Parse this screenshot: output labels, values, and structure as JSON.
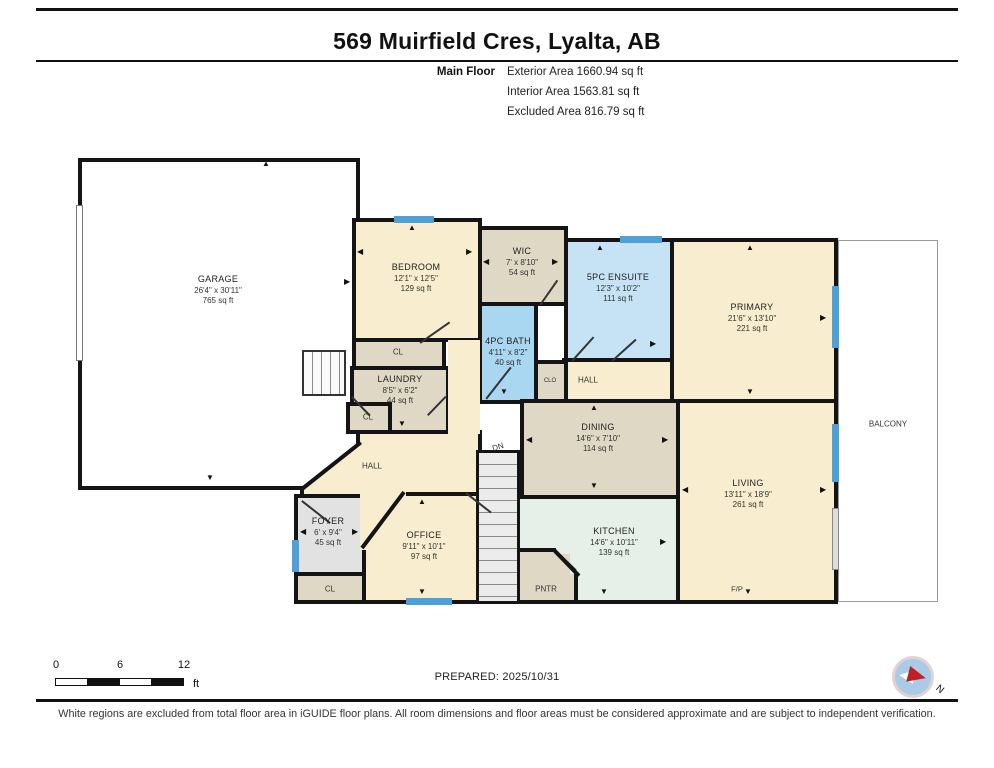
{
  "header": {
    "title": "569 Muirfield Cres, Lyalta, AB",
    "floor_label": "Main Floor",
    "areas": {
      "exterior": "Exterior Area 1660.94 sq ft",
      "interior": "Interior Area 1563.81 sq ft",
      "excluded": "Excluded Area 816.79 sq ft"
    }
  },
  "rooms": {
    "garage": {
      "name": "GARAGE",
      "dims": "26'4\" x 30'11\"",
      "area": "765 sq ft"
    },
    "bedroom": {
      "name": "BEDROOM",
      "dims": "12'1\" x 12'5\"",
      "area": "129 sq ft"
    },
    "wic": {
      "name": "WIC",
      "dims": "7' x 8'10\"",
      "area": "54 sq ft"
    },
    "bath": {
      "name": "4PC BATH",
      "dims": "4'11\" x 8'2\"",
      "area": "40 sq ft"
    },
    "ensuite": {
      "name": "5PC ENSUITE",
      "dims": "12'3\" x 10'2\"",
      "area": "111 sq ft"
    },
    "primary": {
      "name": "PRIMARY",
      "dims": "21'6\" x 13'10\"",
      "area": "221 sq ft"
    },
    "laundry": {
      "name": "LAUNDRY",
      "dims": "8'5\" x 6'2\"",
      "area": "44 sq ft"
    },
    "dining": {
      "name": "DINING",
      "dims": "14'6\" x 7'10\"",
      "area": "114 sq ft"
    },
    "kitchen": {
      "name": "KITCHEN",
      "dims": "14'6\" x 10'11\"",
      "area": "139 sq ft"
    },
    "living": {
      "name": "LIVING",
      "dims": "13'11\" x 18'9\"",
      "area": "261 sq ft"
    },
    "office": {
      "name": "OFFICE",
      "dims": "9'11\" x 10'1\"",
      "area": "97 sq ft"
    },
    "foyer": {
      "name": "FOYER",
      "dims": "6' x 9'4\"",
      "area": "45 sq ft"
    },
    "balcony": {
      "name": "BALCONY"
    }
  },
  "labels": {
    "cl": "CL",
    "clo": "CLO",
    "hall": "HALL",
    "pntr": "PNTR",
    "dn": "DN",
    "fp": "F/P"
  },
  "icons": {
    "arrow_up": "▲",
    "arrow_down": "▼",
    "arrow_left": "◀",
    "arrow_right": "▶",
    "north_label": "N",
    "compass": "compass-rose"
  },
  "scale_bar": {
    "start": "0",
    "mid": "6",
    "end": "12",
    "unit": "ft"
  },
  "footer": {
    "prepared": "PREPARED: 2025/10/31"
  },
  "disclaimer": "White regions are excluded from total floor area in iGUIDE floor plans. All room dimensions and floor areas must be considered approximate and are subject to independent verification.",
  "colors": {
    "wall": "#141414",
    "room_cream": "#F8EECF",
    "room_tan": "#DFD8C5",
    "bath_blue": "#A9D6F0",
    "ensuite_blue": "#C5E3F5",
    "kitchen_mint": "#E6F0E8",
    "foyer_gray": "#E2E2E2",
    "window_blue": "#4FA0D6",
    "compass_red": "#C02020"
  }
}
